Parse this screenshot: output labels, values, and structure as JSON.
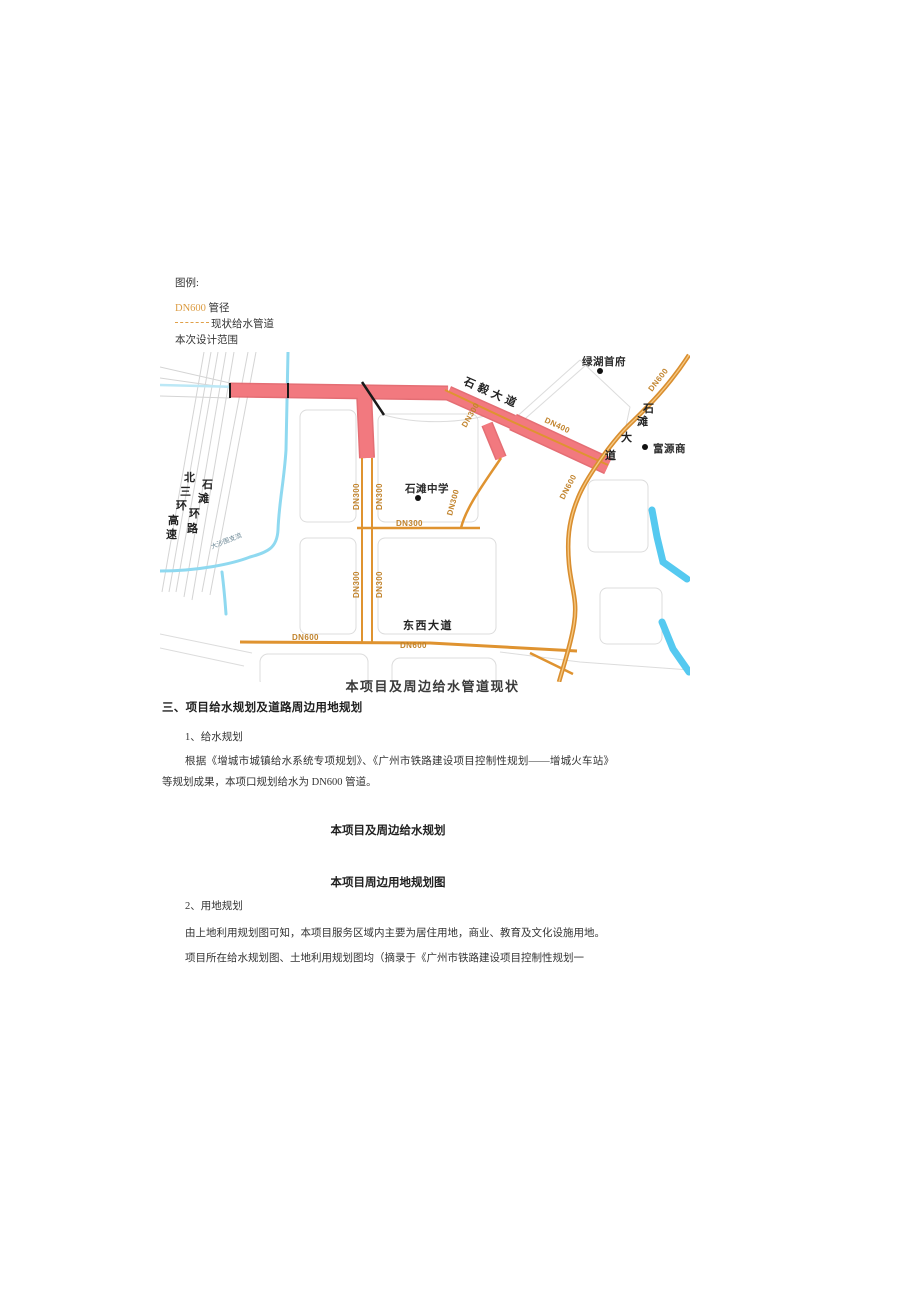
{
  "legend": {
    "title": "图例:",
    "dn_label": "DN600",
    "dn_rest": "管径",
    "existing_pipe": "现状给水管道",
    "scope": "本次设计范围"
  },
  "map": {
    "caption": "本项目及周边给水管道现状",
    "labels": {
      "dn300": "DN300",
      "dn400": "DN400",
      "dn600": "DN600",
      "school": "石滩中学",
      "estate": "绿湖首府",
      "mall": "富源商",
      "east_west": "东西大道",
      "shiyi_road": "石毅大道",
      "shitan_chars": [
        "石",
        "滩",
        "大",
        "道"
      ],
      "north_ring_chars": [
        "北",
        "三",
        "环",
        "高",
        "速"
      ],
      "shitan_ring_chars": [
        "石",
        "滩",
        "环",
        "路"
      ],
      "river": "大沙围支流"
    },
    "colors": {
      "pipe": "#DF9330",
      "scope": "#F2797F",
      "scope_edge": "#E25F66",
      "water": "#8FD9F0",
      "water_deep": "#55C9F0",
      "road": "#D8D8D8",
      "dn_label": "#C1832C"
    }
  },
  "sections": {
    "heading3": "三、项目给水规划及道路周边用地规划",
    "sub1": "1、给水规划",
    "para1": "根据《增城市城镇给水系统专项规划》、《广州市铁路建设项目控制性规划——增城火车站》等规划成果，本项口规划给水为 DN600 管道。",
    "fig_caption2": "本项目及周边给水规划",
    "fig_caption3": "本项目周边用地规划图",
    "sub2": "2、用地规划",
    "para2": "由上地利用规划图可知，本项目服务区域内主要为居住用地，商业、教育及文化设施用地。",
    "para3": "项目所在给水规划图、土地利用规划图均（摘录于《广州市铁路建设项目控制性规划一"
  }
}
